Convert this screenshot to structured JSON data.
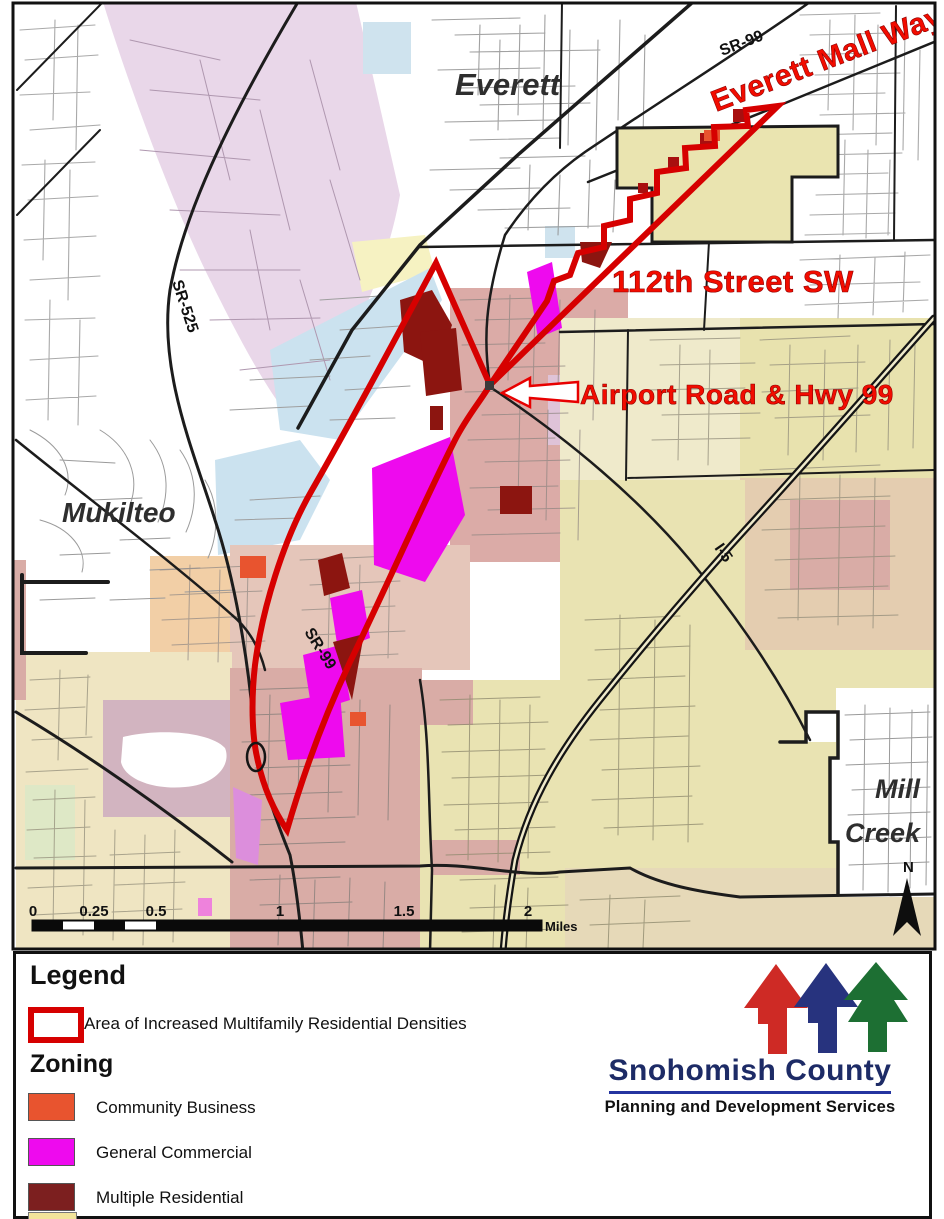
{
  "map": {
    "cities": [
      {
        "name": "Everett"
      },
      {
        "name": "Mukilteo"
      },
      {
        "name": "Mill Creek",
        "line1": "Mill",
        "line2": "Creek"
      }
    ],
    "road_labels": [
      {
        "name": "SR-99"
      },
      {
        "name": "SR-525"
      },
      {
        "name": "SR-99"
      },
      {
        "name": "I-5"
      }
    ],
    "annotations": [
      {
        "text": "Everett Mall Way"
      },
      {
        "text": "112th Street SW"
      },
      {
        "text": "Airport Road & Hwy 99"
      }
    ],
    "scale_bar": {
      "ticks": [
        "0",
        "0.25",
        "0.5",
        "1",
        "1.5",
        "2"
      ],
      "unit": "Miles"
    },
    "compass_label": "N",
    "highlight_outline_color": "#d60000"
  },
  "legend": {
    "title": "Legend",
    "area_item": {
      "label": "Area of Increased Multifamily Residential Densities",
      "outline_color": "#d60000"
    },
    "zoning_title": "Zoning",
    "zoning_items": [
      {
        "label": "Community Business",
        "color": "#e8542f"
      },
      {
        "label": "General Commercial",
        "color": "#ee0aee"
      },
      {
        "label": "Multiple Residential",
        "color": "#7c1f1f"
      }
    ]
  },
  "logo": {
    "org_name": "Snohomish County",
    "department": "Planning and Development Services",
    "arrow_colors": {
      "red": "#ce2a25",
      "blue": "#27337e",
      "green": "#1d6f33"
    }
  }
}
